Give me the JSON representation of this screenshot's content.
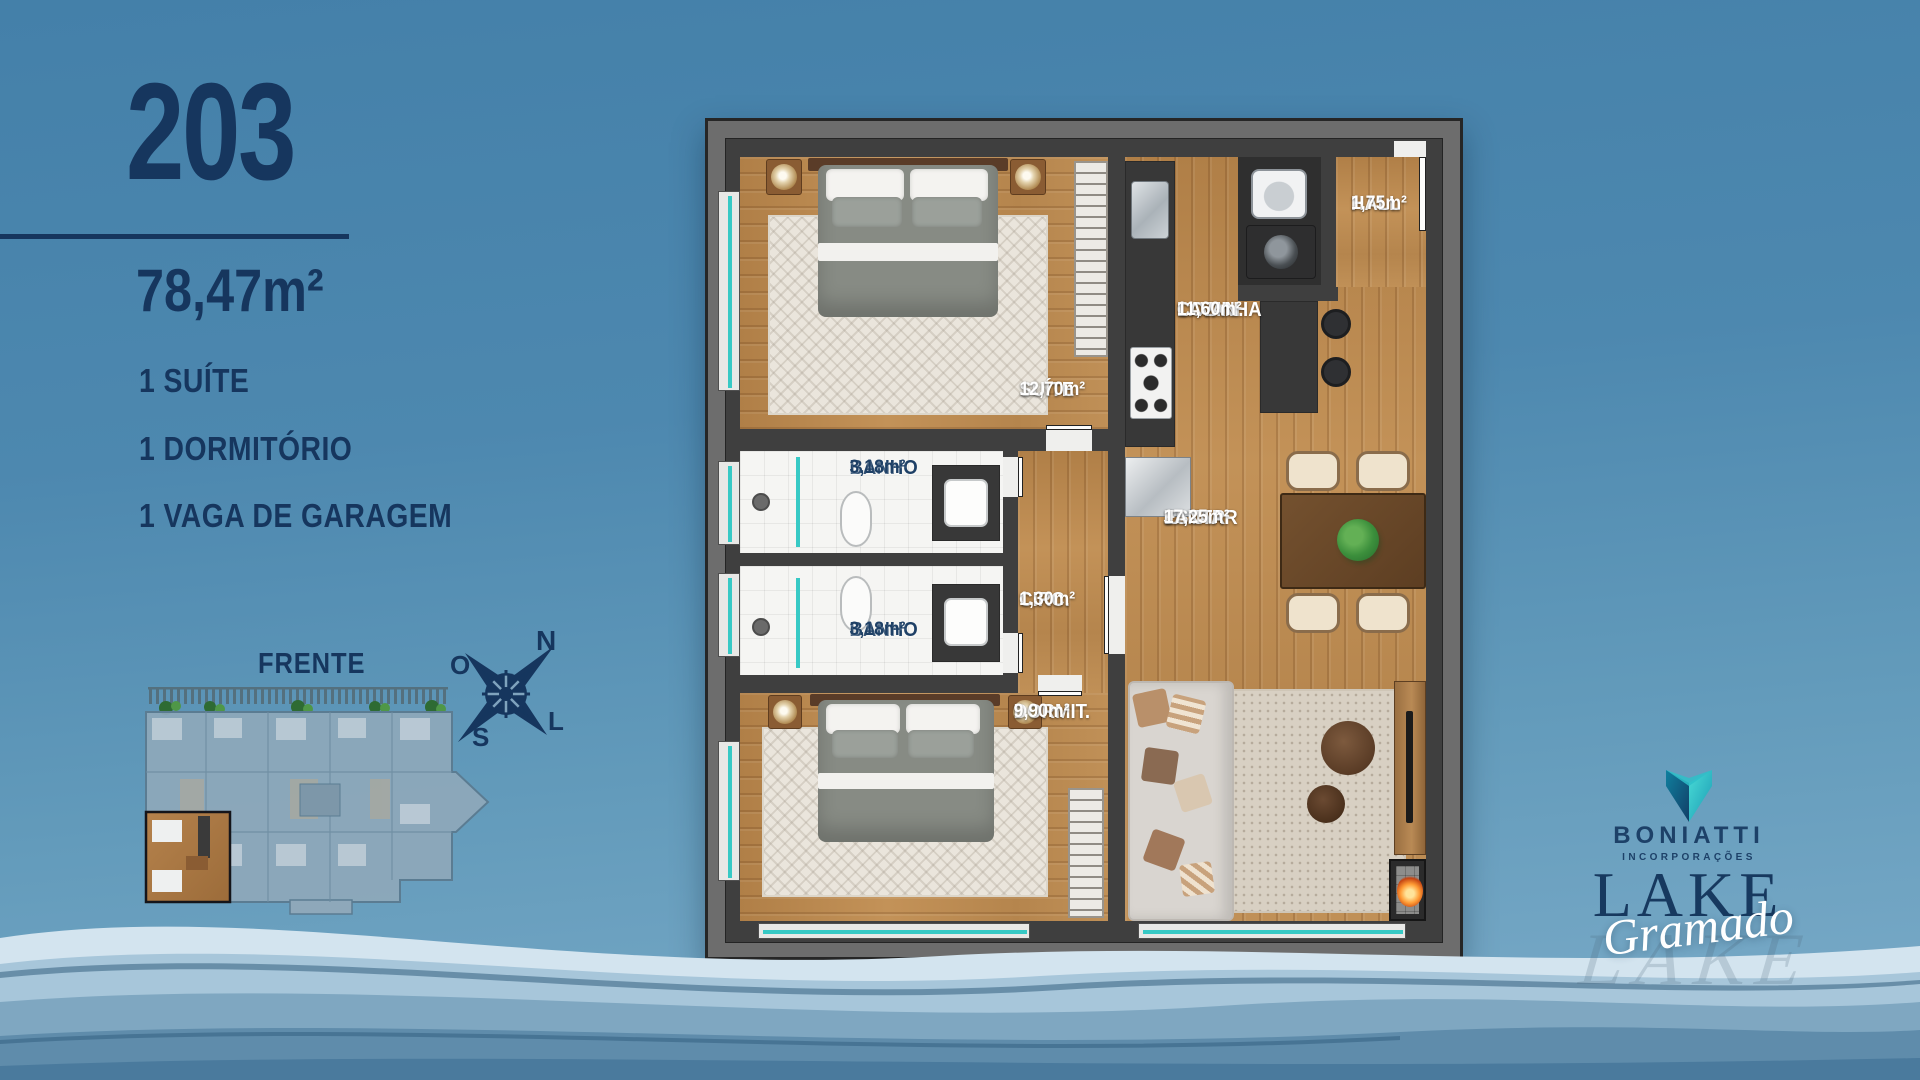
{
  "unit": {
    "number": "203",
    "area": "78,47m²",
    "features": [
      "1 SUÍTE",
      "1 DORMITÓRIO",
      "1 VAGA DE GARAGEM"
    ]
  },
  "keyplan": {
    "front_label": "FRENTE",
    "unit_label": "203"
  },
  "compass": {
    "north": "N",
    "south": "S",
    "east": "L",
    "west": "O"
  },
  "plan": {
    "rooms": {
      "hall": {
        "name": "HALL",
        "area": "1,75m²"
      },
      "cozinha": {
        "name": "COZINHA",
        "name2": "LAVAN.",
        "area": "11,60m²"
      },
      "suite": {
        "name": "SUÍTE",
        "area": "12,70m²"
      },
      "banho1": {
        "name": "BANHO",
        "area": "3,18m²"
      },
      "banho2": {
        "name": "BANHO",
        "area": "3,18m²"
      },
      "circ": {
        "name": "CIRC.",
        "area": "1,30m²"
      },
      "estar": {
        "name": "ESTAR",
        "name2": "JANTAR",
        "area": "17,25m²"
      },
      "dormit": {
        "name": "DORMIT.",
        "area": "9,90m²"
      }
    }
  },
  "branding": {
    "company": "BONIATTI",
    "company_sub": "INCORPORAÇÕES",
    "project": "LAKE",
    "project_script": "Gramado"
  },
  "colors": {
    "navy": "#16365e",
    "teal_glass": "#37c9c5",
    "wood": "#b9884f",
    "sky_top": "#4480a9",
    "sky_bottom": "#7cacc9",
    "wall_grey": "#6d6d6d"
  }
}
